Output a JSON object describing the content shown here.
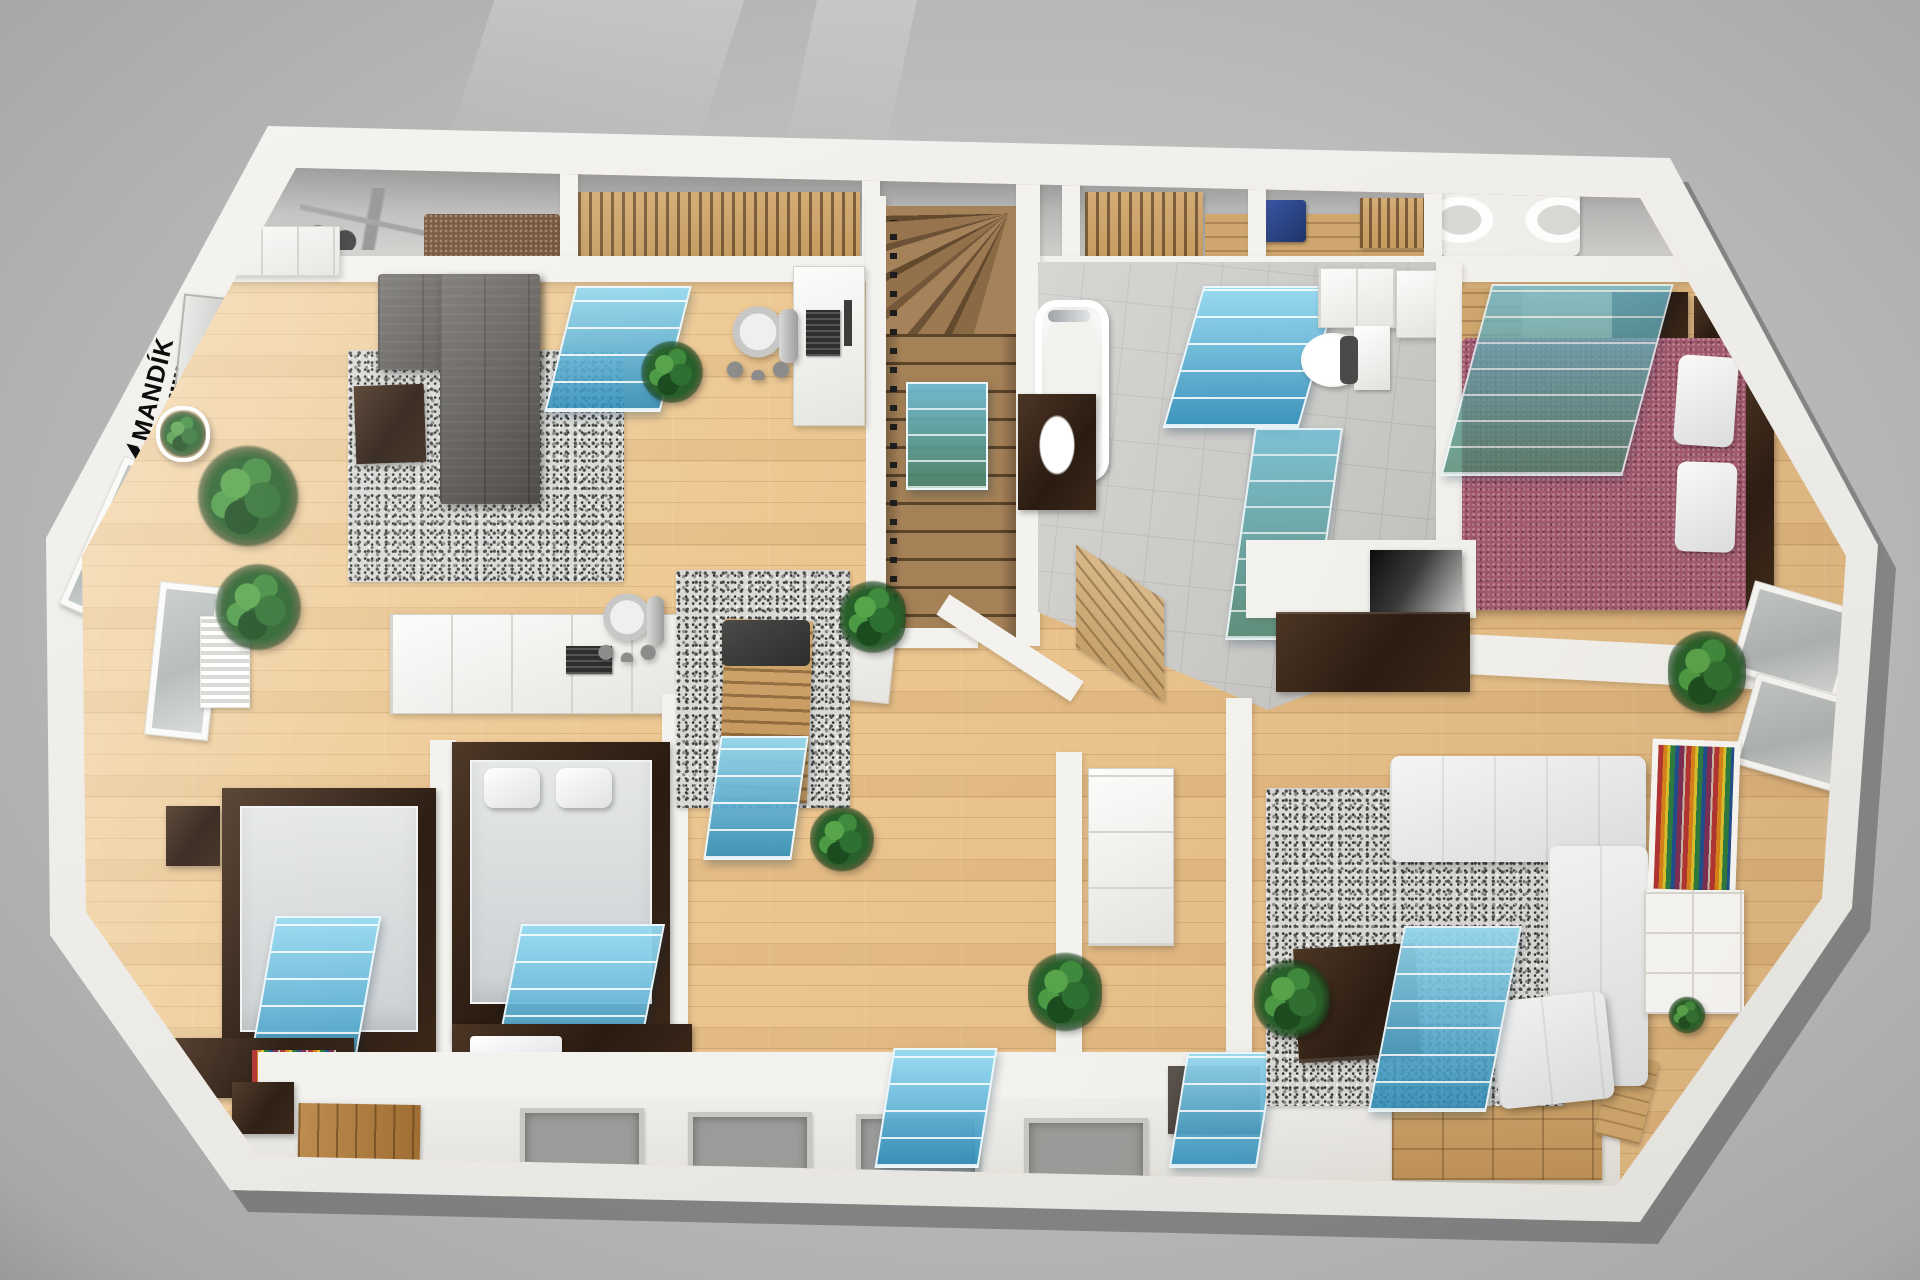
{
  "watermark": {
    "brand": "MANDÍK"
  },
  "scene": {
    "kind": "3d-floor-plan-render",
    "view": "top-down",
    "rooms": [
      {
        "name": "study-lounge",
        "floor": "light-wood",
        "items": [
          "charcoal-corner-sofa",
          "pebble-rug",
          "dark-coffee-table",
          "wall-tv",
          "skylight-glass",
          "office-desk",
          "office-chair",
          "plant",
          "white-cabinet"
        ]
      },
      {
        "name": "staircase",
        "items": [
          "wood-winder-stairs",
          "green-glass-balustrade",
          "black-railing"
        ]
      },
      {
        "name": "bathroom",
        "floor": "grey-tile",
        "items": [
          "bathtub",
          "shower-glass",
          "toilet",
          "vanity-sink",
          "wall-cabinets"
        ]
      },
      {
        "name": "bedroom-burgundy",
        "floor": "light-wood",
        "items": [
          "double-bed-burgundy",
          "white-pillows",
          "skylight-glass",
          "tan-wardrobe",
          "dark-nightstands",
          "mirror-closet"
        ]
      },
      {
        "name": "central-hall",
        "items": [
          "wooden-lounger",
          "pebble-rug",
          "skylight-glass",
          "white-wardrobe",
          "dark-sideboard",
          "wall-tv",
          "plants"
        ]
      },
      {
        "name": "bedroom-left",
        "items": [
          "double-bed-dark-frame",
          "skylight-glass",
          "storage-bench",
          "colorful-books",
          "nightstand"
        ]
      },
      {
        "name": "bedroom-master",
        "items": [
          "double-bed-dark-frame",
          "white-cabinet-desk",
          "office-chair",
          "skylight-glass",
          "storage-bench",
          "pillows"
        ]
      },
      {
        "name": "living-room",
        "floor": "light-wood",
        "items": [
          "white-corner-sofa",
          "pebble-rug",
          "dark-coffee-table",
          "colorful-bookshelf",
          "cube-shelf",
          "skylight-glass",
          "windows",
          "plants"
        ]
      },
      {
        "name": "attic-storage-strip",
        "items": [
          "gym-equipment",
          "clothes-closets",
          "carpet-roll",
          "corner-bathtub",
          "blue-laundry-bin",
          "wood-panel"
        ]
      },
      {
        "name": "entry-strip",
        "items": [
          "wood-entrance-door",
          "doormats",
          "dark-side-table",
          "wood-dressers",
          "small-wood-table"
        ]
      }
    ],
    "counts": {
      "skylight_glass_panels": 10,
      "doormats": 4,
      "plants": 9,
      "office_chairs": 2
    }
  },
  "palette": {
    "background": "#bcbcbc",
    "walls": "#f3f2ee",
    "wood_floor": "#ecc58f",
    "stair_wood": "#a58157",
    "tile": "#c9c8c4",
    "glass_blue": "#4fb2dc",
    "glass_green": "#4f8f78",
    "sofa_charcoal": "#5e5b57",
    "sofa_white": "#eef0f2",
    "bed_burgundy": "#a2586e",
    "furniture_dark": "#31221 7",
    "furniture_tan": "#cfa76e",
    "plant_green": "#2f7d32"
  }
}
